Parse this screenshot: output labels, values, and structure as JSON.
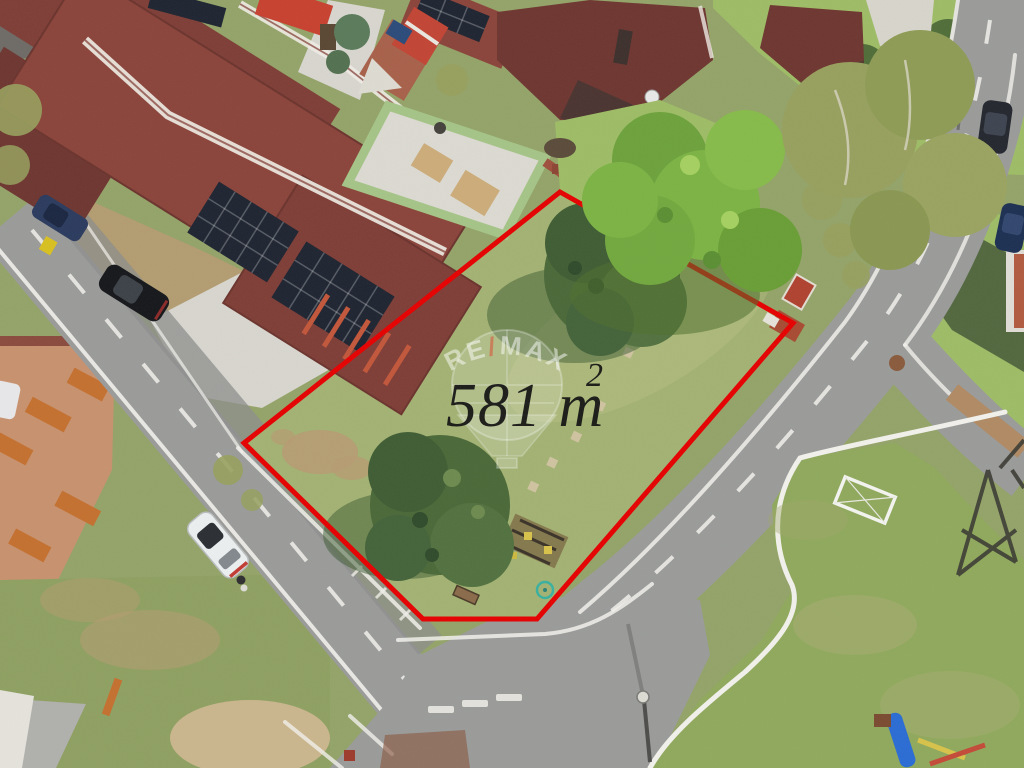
{
  "overlay": {
    "area_label": "581 m",
    "area_superscript": "2",
    "watermark": {
      "brand_left": "RE",
      "brand_slash": "/",
      "brand_right": "MAX"
    }
  },
  "plot": {
    "outline_points": "560,192 793,323 537,619 423,619 244,443"
  },
  "colors": {
    "outline_red": "#e60000",
    "roof_red": "#7e3d36",
    "roof_red_dark": "#6e3530",
    "roof_red_light": "#8a433a",
    "solar_panel": "#1d2330",
    "asphalt": "#9a9b9a",
    "asphalt_dark": "#8c8d8c",
    "concrete_white": "#d8d6cf",
    "curb_white": "#f2f1ec",
    "grass_base": "#93a368",
    "grass_plot": "#a3b273",
    "grass_bright": "#9ebc66",
    "grass_park": "#8fa95c",
    "conifer": "#4a6838",
    "conifer_shadow": "#3c5a31",
    "lime_tree": "#7cb344",
    "olive_tree": "#97a05e",
    "dirt_tan": "#b79b72",
    "terracotta": "#c8916e",
    "orange_tile": "#c4702f",
    "brick": "#a8604a",
    "green_wall": "#a5c487",
    "watermark_white": "rgba(255,255,255,0.5)"
  },
  "scene": {
    "description": "Aerial drone view of a building plot outlined in red among family houses with dark red roofs, rooftop solar panels, residential streets, mature trees and a small playground park.",
    "objects": [
      "building-plot",
      "red-roof-houses",
      "solar-panel-arrays",
      "conifer-trees",
      "deciduous-trees",
      "residential-streets",
      "white-car",
      "parked-cars",
      "park-lawn",
      "soccer-goal",
      "playground-slide",
      "terracotta-patio",
      "brick-house-construction",
      "power-pylon",
      "street-lamp"
    ]
  }
}
